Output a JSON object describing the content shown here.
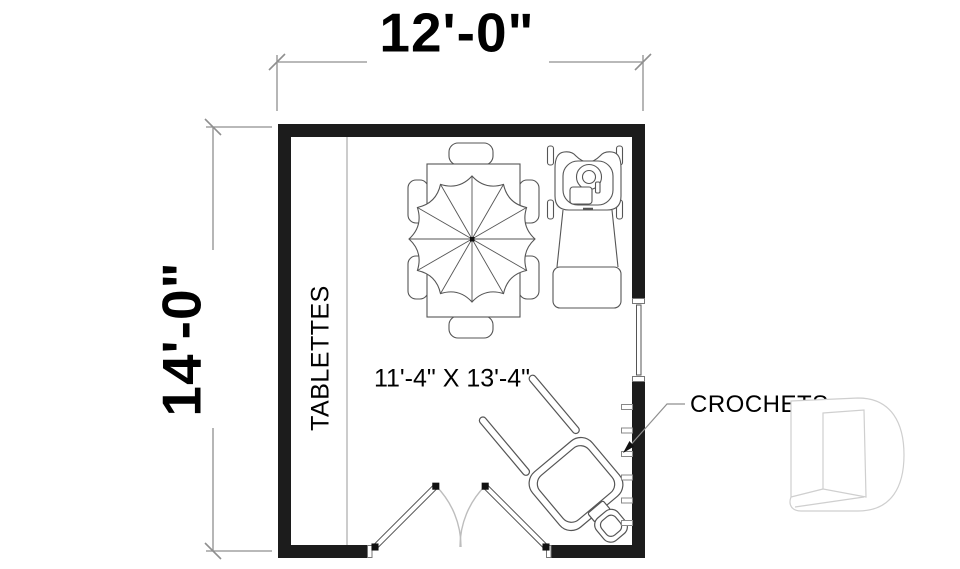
{
  "dimensions": {
    "width": {
      "label": "12'-0\""
    },
    "height": {
      "label": "14'-0\""
    }
  },
  "room": {
    "size_label": "11'-4\" X 13'-4\"",
    "shelves_label": "TABLETTES",
    "hooks_label": "CROCHETS"
  },
  "objects": {
    "table": "table with umbrella and 6 chairs",
    "mower": "lawn mower",
    "wheelbarrow": "wheelbarrow",
    "hooks_count": 6,
    "door": "double swing door",
    "window": "window",
    "watermark": "D logo watermark"
  },
  "colors": {
    "wall": "#1c1c1c",
    "line": "#555555",
    "dimension": "#8f8f8f",
    "swing_arc": "#bdbdbd",
    "watermark": "#cfcfcf",
    "text": "#000000"
  }
}
